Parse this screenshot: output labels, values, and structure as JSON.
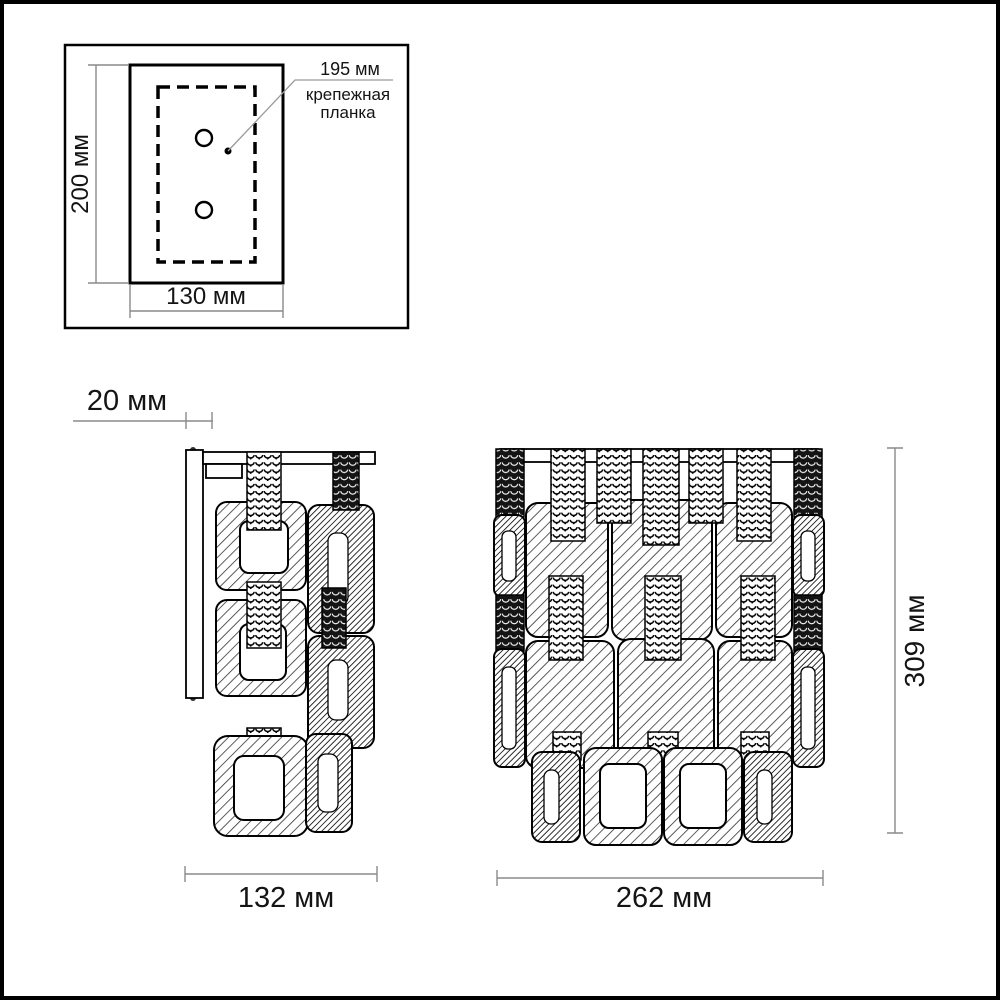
{
  "views": {
    "mounting_detail": {
      "height_label": "200 мм",
      "width_label": "130 мм",
      "callout_length_label": "195 мм",
      "callout_caption_line1": "крепежная",
      "callout_caption_line2": "планка"
    },
    "side_view": {
      "wall_offset_label": "20 мм",
      "width_label": "132 мм"
    },
    "front_view": {
      "width_label": "262 мм",
      "height_label": "309 мм"
    }
  },
  "colors": {
    "outline": "#000000",
    "dimension_line": "#8a8a8a",
    "background": "#ffffff"
  }
}
